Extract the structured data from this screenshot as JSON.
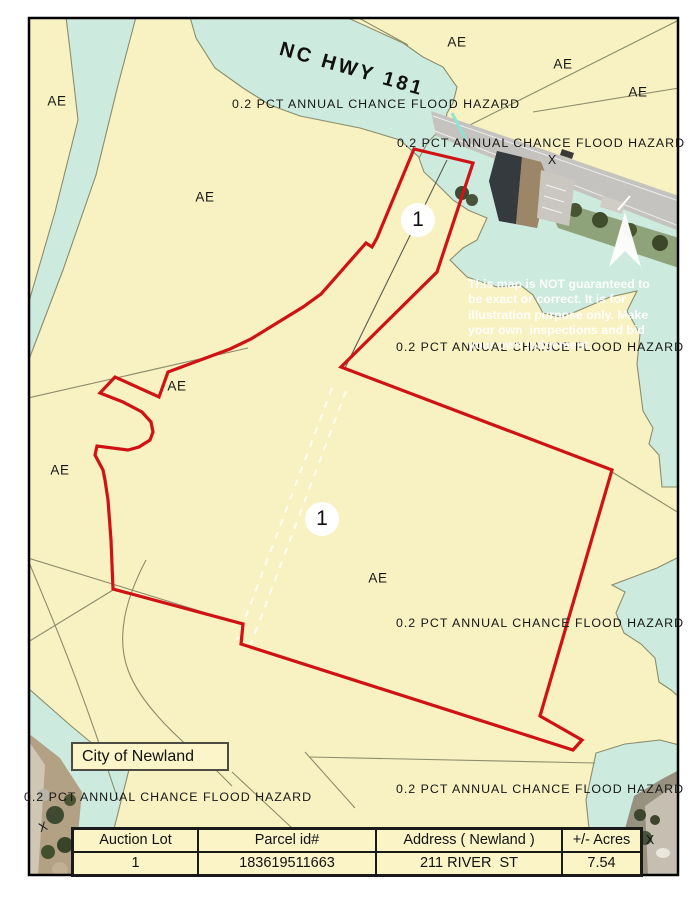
{
  "map": {
    "title_context": "FEMA flood hazard map with auction parcel",
    "highway_label": "NC HWY 181",
    "flood_hazard_label": "0.2 PCT ANNUAL CHANCE FLOOD HAZARD",
    "zone_ae_label": "AE",
    "zone_x_label": "X",
    "lot_marker_label": "1",
    "city_label": "City of Newland",
    "disclaimer": {
      "line1": "This map is NOT guaranteed to",
      "line2": "be exact or correct. It is for",
      "line3": "illustration purpose only. Make",
      "line4": "your own  inspections and bid",
      "line5": "your own judgement."
    },
    "colors": {
      "zone_ae_fill": "#F8F1C1",
      "zone_500yr_fill": "#CCEBDE",
      "parcel_outline": "#D01215",
      "boundary_line": "#8C8C6B",
      "map_border": "#000000"
    }
  },
  "table": {
    "headers": {
      "lot": "Auction Lot",
      "parcel": "Parcel id#",
      "address": "Address ( Newland )",
      "acres": "+/- Acres"
    },
    "row": {
      "lot": "1",
      "parcel": "183619511663",
      "address": "211 RIVER  ST",
      "acres": "7.54"
    }
  }
}
